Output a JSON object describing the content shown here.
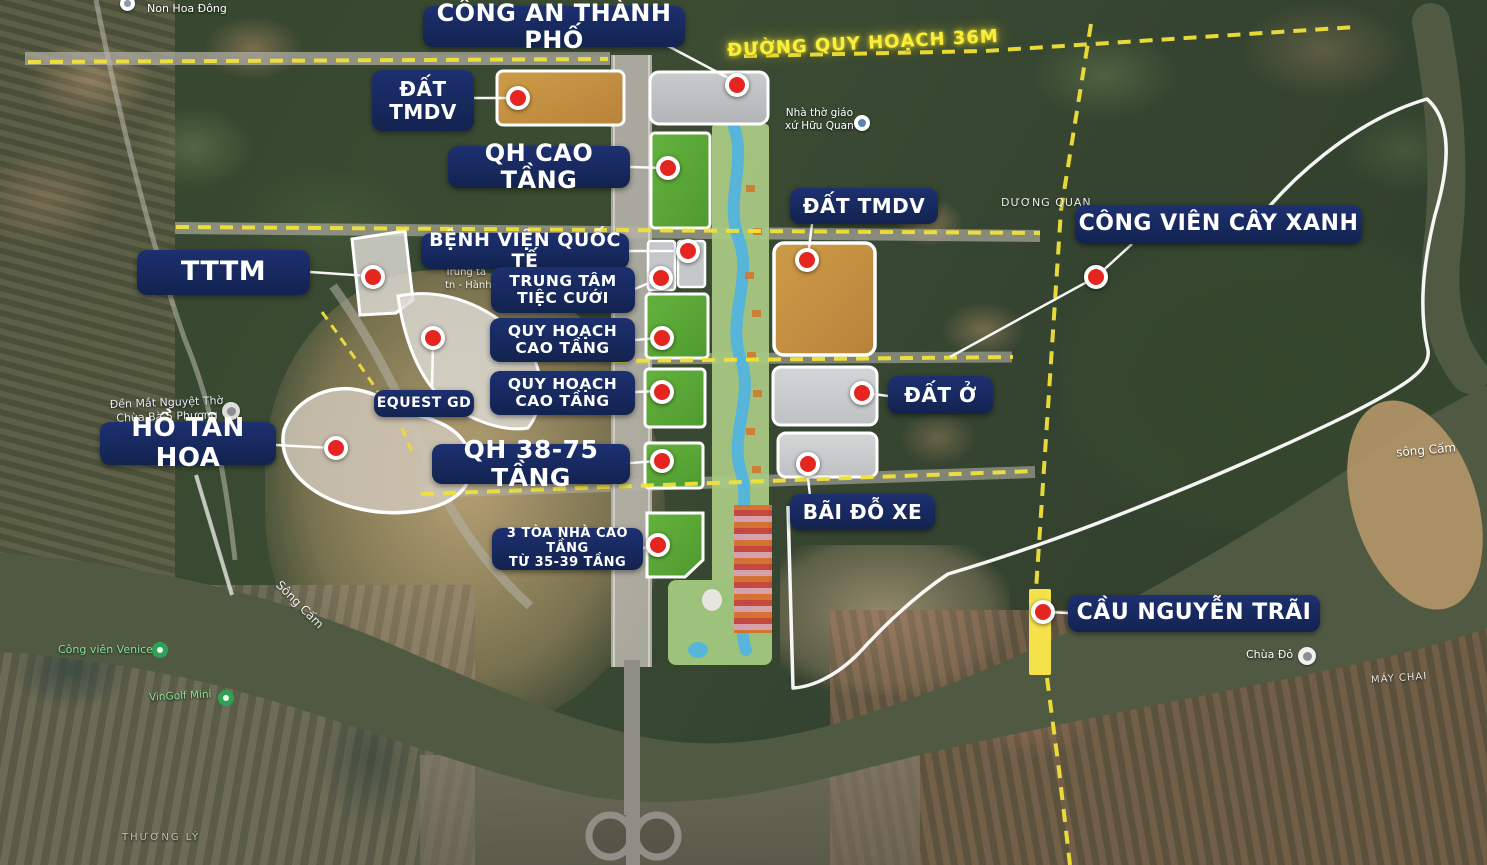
{
  "labels": {
    "cong_an": "CÔNG AN THÀNH PHỐ",
    "dat_tmdv_left": {
      "line1": "ĐẤT",
      "line2": "TMDV"
    },
    "qh_cao_tang": "QH CAO TẦNG",
    "benh_vien": "BỆNH VIỆN QUỐC TẾ",
    "trung_tam": {
      "line1": "TRUNG TÂM",
      "line2": "TIỆC CƯỚI"
    },
    "quy_hoach": {
      "line1": "QUY HOẠCH",
      "line2": "CAO TẦNG"
    },
    "tttm": "TTTM",
    "equest": "EQUEST GD",
    "ho_tan_hoa": "HỒ TÂN HOA",
    "qh_38_75": "QH 38-75 TẦNG",
    "ba_toa": {
      "line1": "3 TÒA NHÀ CAO TẦNG",
      "line2": "TỪ 35-39 TẦNG"
    },
    "dat_tmdv_right": "ĐẤT TMDV",
    "dat_o": "ĐẤT Ở",
    "bai_do_xe": "BÃI ĐỖ XE",
    "cong_vien": "CÔNG VIÊN CÂY XANH",
    "cau_nguyen_trai": "CẦU NGUYỄN TRÃI",
    "duong_quy_hoach": "ĐƯỜNG QUY HOẠCH 36M"
  },
  "map_texts": {
    "non_hoa_dong": "Non Hoa Đông",
    "nha_tho": {
      "line1": "Nhà thờ giáo",
      "line2": "xứ Hữu Quan"
    },
    "duong_quan": "DƯƠNG QUAN",
    "song_cam_right": "sông Cấm",
    "song_cam_left": "Sông Cấm",
    "chua_do": "Chùa Đỏ",
    "may_chai": "MÁY CHAI",
    "cong_vien_venice": "Công viên Venice",
    "vingolf": "VinGolf Mini",
    "thuong_ly": "THƯƠNG LÝ",
    "den": {
      "line1": "Đền Mắt Nguyệt Thờ",
      "line2": "Chùa Bà 5 Phương"
    },
    "trung_ta": {
      "line1": "Trung tâ",
      "line2": "tn - Hành"
    }
  },
  "colors": {
    "label_bg": "#16275f",
    "marker_red": "#e52620",
    "dashed_yellow": "#f0e139",
    "bridge_highlight": "#f5e24a",
    "parcel_green": "#5ca93a",
    "parcel_orange": "#c3903f",
    "parcel_gray": "#c3c5c7"
  }
}
